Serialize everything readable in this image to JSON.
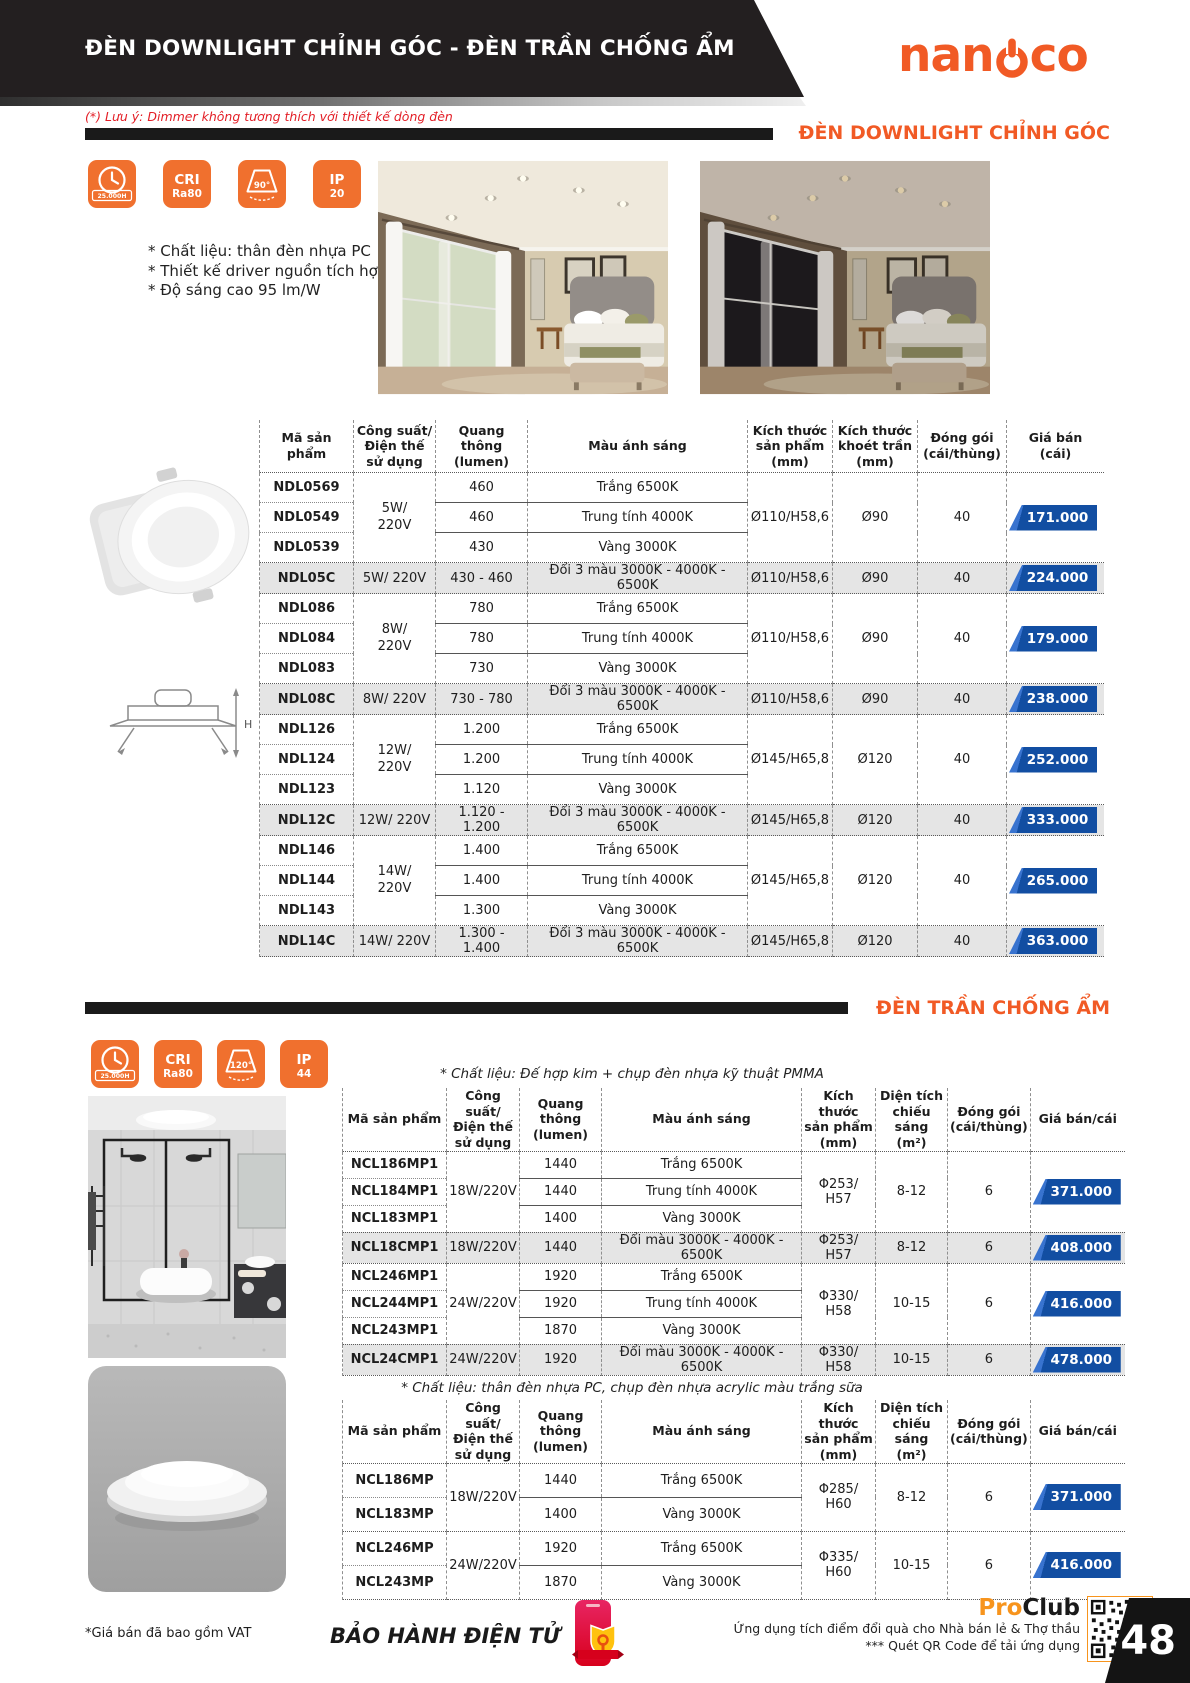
{
  "header": {
    "banner_title": "ĐÈN DOWNLIGHT CHỈNH GÓC - ĐÈN TRẦN CHỐNG ẨM",
    "brand_pre": "nan",
    "brand_post": "co",
    "dimmer_note": "(*) Lưu ý: Dimmer không tương thích với thiết kế dòng đèn"
  },
  "colors": {
    "accent_orange": "#F15A25",
    "icon_orange": "#F0702E",
    "price_badge_blue": "#124EA2",
    "banner_black": "#231F20",
    "note_red": "#E31E26"
  },
  "section1": {
    "title": "ĐÈN DOWNLIGHT CHỈNH GÓC",
    "icons": [
      {
        "name": "lifetime-icon",
        "text": "25.000H"
      },
      {
        "name": "cri-icon",
        "top": "CRI",
        "bottom": "Ra80"
      },
      {
        "name": "beam-angle-icon",
        "text": "90°"
      },
      {
        "name": "ip-rating-icon",
        "top": "IP",
        "bottom": "20"
      }
    ],
    "features": [
      "* Chất liệu: thân đèn nhựa PC",
      "* Thiết kế driver nguồn tích hợp",
      "* Độ sáng cao 95 lm/W"
    ],
    "drawing_label": "H"
  },
  "table1": {
    "headers": [
      "Mã sản phẩm",
      "Công suất/\nĐiện thế\nsử dụng",
      "Quang thông\n(lumen)",
      "Màu ánh sáng",
      "Kích thước\nsản phẩm\n(mm)",
      "Kích thước\nkhoét trần\n(mm)",
      "Đóng gói\n(cái/thùng)",
      "Giá bán\n(cái)"
    ],
    "groups": [
      {
        "power": "5W/\n220V",
        "size": "Ø110/H58,6",
        "cutout": "Ø90",
        "pack": "40",
        "price": "171.000",
        "rows": [
          {
            "code": "NDL0569",
            "lumen": "460",
            "color": "Trắng 6500K"
          },
          {
            "code": "NDL0549",
            "lumen": "460",
            "color": "Trung tính 4000K"
          },
          {
            "code": "NDL0539",
            "lumen": "430",
            "color": "Vàng 3000K"
          }
        ]
      },
      {
        "code": "NDL05C",
        "power": "5W/ 220V",
        "lumen": "430 - 460",
        "color": "Đổi 3 màu 3000K - 4000K - 6500K",
        "size": "Ø110/H58,6",
        "cutout": "Ø90",
        "pack": "40",
        "price": "224.000"
      },
      {
        "power": "8W/\n220V",
        "size": "Ø110/H58,6",
        "cutout": "Ø90",
        "pack": "40",
        "price": "179.000",
        "rows": [
          {
            "code": "NDL086",
            "lumen": "780",
            "color": "Trắng 6500K"
          },
          {
            "code": "NDL084",
            "lumen": "780",
            "color": "Trung tính 4000K"
          },
          {
            "code": "NDL083",
            "lumen": "730",
            "color": "Vàng 3000K"
          }
        ]
      },
      {
        "code": "NDL08C",
        "power": "8W/ 220V",
        "lumen": "730 - 780",
        "color": "Đổi 3 màu 3000K - 4000K - 6500K",
        "size": "Ø110/H58,6",
        "cutout": "Ø90",
        "pack": "40",
        "price": "238.000"
      },
      {
        "power": "12W/\n220V",
        "size": "Ø145/H65,8",
        "cutout": "Ø120",
        "pack": "40",
        "price": "252.000",
        "rows": [
          {
            "code": "NDL126",
            "lumen": "1.200",
            "color": "Trắng 6500K"
          },
          {
            "code": "NDL124",
            "lumen": "1.200",
            "color": "Trung tính 4000K"
          },
          {
            "code": "NDL123",
            "lumen": "1.120",
            "color": "Vàng 3000K"
          }
        ]
      },
      {
        "code": "NDL12C",
        "power": "12W/ 220V",
        "lumen": "1.120 - 1.200",
        "color": "Đổi 3 màu 3000K - 4000K - 6500K",
        "size": "Ø145/H65,8",
        "cutout": "Ø120",
        "pack": "40",
        "price": "333.000"
      },
      {
        "power": "14W/\n220V",
        "size": "Ø145/H65,8",
        "cutout": "Ø120",
        "pack": "40",
        "price": "265.000",
        "rows": [
          {
            "code": "NDL146",
            "lumen": "1.400",
            "color": "Trắng 6500K"
          },
          {
            "code": "NDL144",
            "lumen": "1.400",
            "color": "Trung tính 4000K"
          },
          {
            "code": "NDL143",
            "lumen": "1.300",
            "color": "Vàng 3000K"
          }
        ]
      },
      {
        "code": "NDL14C",
        "power": "14W/ 220V",
        "lumen": "1.300 - 1.400",
        "color": "Đổi 3 màu 3000K - 4000K - 6500K",
        "size": "Ø145/H65,8",
        "cutout": "Ø120",
        "pack": "40",
        "price": "363.000"
      }
    ]
  },
  "section2": {
    "title": "ĐÈN TRẦN CHỐNG ẨM",
    "icons": [
      {
        "name": "lifetime-icon",
        "text": "25.000H"
      },
      {
        "name": "cri-icon",
        "top": "CRI",
        "bottom": "Ra80"
      },
      {
        "name": "beam-angle-icon",
        "text": "120°"
      },
      {
        "name": "ip-rating-icon",
        "top": "IP",
        "bottom": "44"
      }
    ],
    "note_pmma": "* Chất liệu: Đế hợp kim + chụp đèn nhựa kỹ thuật PMMA",
    "note_pc": "* Chất liệu: thân đèn nhựa PC, chụp đèn nhựa acrylic màu trắng sữa"
  },
  "table2": {
    "headers": [
      "Mã sản phẩm",
      "Công suất/\nĐiện thế\nsử dụng",
      "Quang thông\n(lumen)",
      "Màu ánh sáng",
      "Kích thước\nsản phẩm\n(mm)",
      "Diện tích\nchiếu sáng\n(m²)",
      "Đóng gói\n(cái/thùng)",
      "Giá bán/cái"
    ],
    "groups": [
      {
        "power": "18W/220V",
        "size": "Φ253/ H57",
        "area": "8-12",
        "pack": "6",
        "price": "371.000",
        "rows": [
          {
            "code": "NCL186MP1",
            "lumen": "1440",
            "color": "Trắng 6500K"
          },
          {
            "code": "NCL184MP1",
            "lumen": "1440",
            "color": "Trung tính 4000K"
          },
          {
            "code": "NCL183MP1",
            "lumen": "1400",
            "color": "Vàng 3000K"
          }
        ]
      },
      {
        "code": "NCL18CMP1",
        "power": "18W/220V",
        "lumen": "1440",
        "color": "Đổi màu 3000K - 4000K - 6500K",
        "size": "Φ253/ H57",
        "area": "8-12",
        "pack": "6",
        "price": "408.000"
      },
      {
        "power": "24W/220V",
        "size": "Φ330/ H58",
        "area": "10-15",
        "pack": "6",
        "price": "416.000",
        "rows": [
          {
            "code": "NCL246MP1",
            "lumen": "1920",
            "color": "Trắng 6500K"
          },
          {
            "code": "NCL244MP1",
            "lumen": "1920",
            "color": "Trung tính 4000K"
          },
          {
            "code": "NCL243MP1",
            "lumen": "1870",
            "color": "Vàng 3000K"
          }
        ]
      },
      {
        "code": "NCL24CMP1",
        "power": "24W/220V",
        "lumen": "1920",
        "color": "Đổi màu 3000K - 4000K - 6500K",
        "size": "Φ330/ H58",
        "area": "10-15",
        "pack": "6",
        "price": "478.000"
      }
    ]
  },
  "table3": {
    "groups": [
      {
        "power": "18W/220V",
        "size": "Φ285/ H60",
        "area": "8-12",
        "pack": "6",
        "price": "371.000",
        "rows": [
          {
            "code": "NCL186MP",
            "lumen": "1440",
            "color": "Trắng 6500K"
          },
          {
            "code": "NCL183MP",
            "lumen": "1400",
            "color": "Vàng 3000K"
          }
        ]
      },
      {
        "power": "24W/220V",
        "size": "Φ335/ H60",
        "area": "10-15",
        "pack": "6",
        "price": "416.000",
        "rows": [
          {
            "code": "NCL246MP",
            "lumen": "1920",
            "color": "Trắng 6500K"
          },
          {
            "code": "NCL243MP",
            "lumen": "1870",
            "color": "Vàng 3000K"
          }
        ]
      }
    ]
  },
  "footer": {
    "vat_note": "*Giá bán đã bao gồm VAT",
    "warranty": "BẢO HÀNH ĐIỆN TỬ",
    "club_pre": "Pro",
    "club_post": "Club",
    "app_line1": "Ứng dụng tích điểm đổi quà cho Nhà bán lẻ & Thợ thầu",
    "app_line2": "*** Quét QR Code để tải ứng dụng",
    "page_number": "48"
  }
}
